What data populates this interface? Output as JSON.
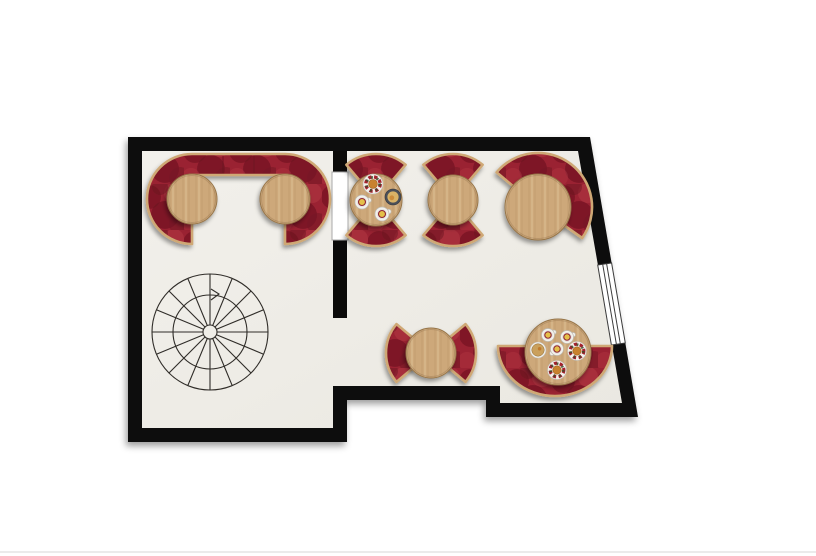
{
  "scene": {
    "canvas_width": 816,
    "canvas_height": 556,
    "background": "#ffffff",
    "bottom_divider_color": "#ebebeb",
    "description": "cafe-floor-plan"
  },
  "palette": {
    "wall": "#0b0a09",
    "floor_light": "#f2f0eb",
    "floor_dark": "#eae8e1",
    "velvet_base": "#9a2231",
    "velvet_dark": "#771523",
    "velvet_deep": "#671120",
    "velvet_light": "#b43a46",
    "wood_base": "#cda87a",
    "wood_grain": "#a9824f",
    "wood_grain_light": "#e3c89e",
    "trim": "#cfa874",
    "table_edge": "#96754a",
    "stair_line": "#2f2c28",
    "door_fill": "#ffffff",
    "door_stroke": "#a8a8a8",
    "window_frame": "#3c3c3c",
    "plate_rim_red": "#a3232e",
    "plate_rim_dark": "#3c4a2a",
    "plate_food": "#c8822f",
    "tea_yellow": "#e5c04a",
    "cup_ring": "#8e2430",
    "bowl_dark": "#4b5058",
    "noodles": "#d9b266",
    "porcelain": "#f3f1ec",
    "porcelain_edge": "#bdbab2"
  },
  "walls": {
    "outer_polygon": [
      [
        128,
        137
      ],
      [
        590,
        137
      ],
      [
        638,
        417
      ],
      [
        486,
        417
      ],
      [
        486,
        400
      ],
      [
        347,
        400
      ],
      [
        347,
        442
      ],
      [
        128,
        442
      ]
    ],
    "floor_polygon": [
      [
        142,
        151
      ],
      [
        578,
        151
      ],
      [
        622,
        403
      ],
      [
        500,
        403
      ],
      [
        500,
        386
      ],
      [
        333,
        386
      ],
      [
        333,
        428
      ],
      [
        142,
        428
      ]
    ],
    "partition_segments": [
      {
        "x": 333,
        "y": 151,
        "w": 14,
        "h": 21
      },
      {
        "x": 333,
        "y": 240,
        "w": 14,
        "h": 78
      }
    ],
    "doorway": {
      "x": 332,
      "y": 172,
      "w": 16,
      "h": 68
    },
    "window": {
      "outer": [
        [
          611.6,
          263
        ],
        [
          625.3,
          343
        ]
      ],
      "inner": [
        [
          597.7,
          265
        ],
        [
          611.4,
          345
        ]
      ],
      "pane_lines": 2
    }
  },
  "staircase": {
    "cx": 210,
    "cy": 332,
    "r_outer": 58,
    "r_mid": 37,
    "r_hub": 7,
    "spokes": 16,
    "arrow": [
      [
        211,
        289
      ],
      [
        219,
        294
      ],
      [
        211,
        300
      ]
    ]
  },
  "banquettes": [
    {
      "id": "banquette-u-left-room",
      "type": "u",
      "c1": [
        192,
        199
      ],
      "c2": [
        285,
        199
      ],
      "r_in": 24,
      "r_out": 45
    },
    {
      "id": "seat-table3-top",
      "type": "arc",
      "c": [
        376,
        200
      ],
      "r_in": 24,
      "r_out": 46,
      "a1": -130,
      "a2": -50
    },
    {
      "id": "seat-table3-bottom",
      "type": "arc",
      "c": [
        376,
        200
      ],
      "r_in": 24,
      "r_out": 46,
      "a1": 50,
      "a2": 130
    },
    {
      "id": "seat-table4-top",
      "type": "arc",
      "c": [
        453,
        200
      ],
      "r_in": 24,
      "r_out": 46,
      "a1": -130,
      "a2": -50
    },
    {
      "id": "seat-table4-bottom",
      "type": "arc",
      "c": [
        453,
        200
      ],
      "r_in": 24,
      "r_out": 46,
      "a1": 50,
      "a2": 130
    },
    {
      "id": "banquette-table5-corner",
      "type": "arc",
      "c": [
        538,
        207
      ],
      "r_in": 30,
      "r_out": 54,
      "a1": -140,
      "a2": 35
    },
    {
      "id": "seat-table6-left",
      "type": "arc",
      "c": [
        431,
        353
      ],
      "r_in": 22,
      "r_out": 45,
      "a1": 140,
      "a2": 220
    },
    {
      "id": "seat-table6-right",
      "type": "arc",
      "c": [
        431,
        353
      ],
      "r_in": 22,
      "r_out": 45,
      "a1": -40,
      "a2": 40
    },
    {
      "id": "banquette-table7-half-round",
      "type": "half_ellipse",
      "c": [
        555,
        346
      ],
      "rx": 57,
      "ry": 50
    }
  ],
  "tables": [
    {
      "id": "table-1",
      "cx": 192,
      "cy": 199,
      "r": 25,
      "food": []
    },
    {
      "id": "table-2",
      "cx": 285,
      "cy": 199,
      "r": 25,
      "food": []
    },
    {
      "id": "table-3",
      "cx": 376,
      "cy": 200,
      "r": 26,
      "food": [
        {
          "type": "plate",
          "dx": -3,
          "dy": -16,
          "r": 10
        },
        {
          "type": "bowl_dark",
          "dx": 17,
          "dy": -3,
          "r": 8
        },
        {
          "type": "cup",
          "dx": -14,
          "dy": 2,
          "r": 7,
          "handle": -15
        },
        {
          "type": "cup",
          "dx": 6,
          "dy": 14,
          "r": 7,
          "handle": -20
        }
      ]
    },
    {
      "id": "table-4",
      "cx": 453,
      "cy": 200,
      "r": 25,
      "food": []
    },
    {
      "id": "table-5",
      "cx": 538,
      "cy": 207,
      "r": 33,
      "food": []
    },
    {
      "id": "table-6",
      "cx": 431,
      "cy": 353,
      "r": 25,
      "food": []
    },
    {
      "id": "table-7",
      "cx": 558,
      "cy": 352,
      "r": 33,
      "food": [
        {
          "type": "cup",
          "dx": -10,
          "dy": -17,
          "r": 6.5,
          "handle": -25
        },
        {
          "type": "cup",
          "dx": 9,
          "dy": -15,
          "r": 6.5,
          "handle": -20
        },
        {
          "type": "bowl_tan",
          "dx": -20,
          "dy": -2,
          "r": 8
        },
        {
          "type": "cup",
          "dx": -1,
          "dy": -3,
          "r": 6.5,
          "handle": 140
        },
        {
          "type": "plate",
          "dx": 19,
          "dy": -1,
          "r": 9.5
        },
        {
          "type": "plate",
          "dx": -1,
          "dy": 18,
          "r": 9.5
        }
      ]
    }
  ]
}
